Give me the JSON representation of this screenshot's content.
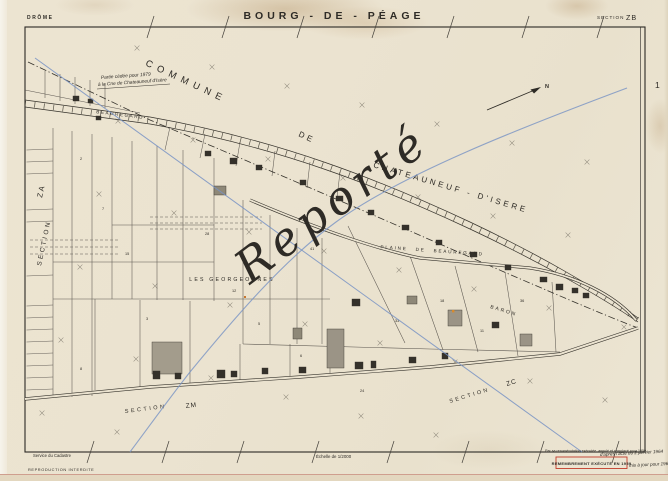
{
  "sheet": {
    "department": "DRÔME",
    "title": "BOURG - DE - PÉAGE",
    "section_word": "SECTION",
    "section_code": "ZB",
    "plate_number": "1"
  },
  "map": {
    "commune_word1": "COMMUNE",
    "commune_word2": "DE",
    "commune_word3": "CHATEAUNEUF - D'ISERE",
    "road_label_beauregard": "BEAUREGARD",
    "plaine_label": "PLAINE  DE  BEAUREGARD",
    "baron_label": "BARON",
    "lieu_dit_georgeonnes": "LES  GEORGEONNES",
    "section_za_word": "SECTION",
    "section_za_code": "ZA",
    "section_zm_word": "SECTION",
    "section_zm_code": "ZM",
    "section_zc_word": "SECTION",
    "section_zc_code": "ZC",
    "north_label": "N",
    "blue_script": "Reporté",
    "note_line1": "Partie cédée pour 1979",
    "note_line2": "à la Cne de Chateauneuf d'Isère",
    "parcel_numbers": [
      "2",
      "7",
      "15",
      "3",
      "28",
      "12",
      "5",
      "41",
      "9",
      "33",
      "18",
      "6",
      "24",
      "11",
      "36",
      "8"
    ]
  },
  "footer": {
    "publisher_line1": "Service du Cadastre",
    "publisher_line2": "REPRODUCTION INTERDITE",
    "scale_label": "Échelle de 1/2000",
    "revision_note": "Par sa renumérotation exécutée, annulé et remplacé pour 1959",
    "stamp_text": "REMEMBREMENT EXÉCUTÉ EN 1959",
    "stamp_hand1": "d'après l'acte du 2 janvier 1964",
    "stamp_hand2": "mis à jour pour 1965 – ZB"
  },
  "colors": {
    "paper": "#ebe3d0",
    "ink": "#2e2b26",
    "blue_line": "#7792c4",
    "stamp_red": "#c23b2a"
  }
}
